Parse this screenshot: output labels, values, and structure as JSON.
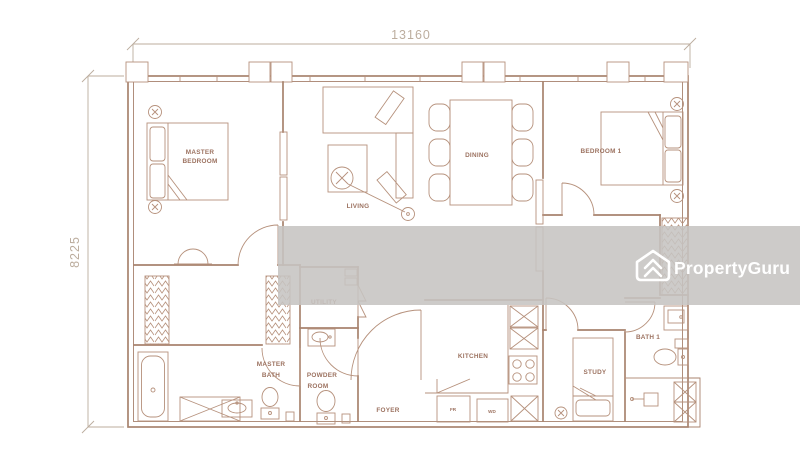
{
  "image": {
    "type": "apartment-floor-plan",
    "width_px": 800,
    "height_px": 456
  },
  "dimensions": {
    "overall_width": "13160",
    "overall_depth": "8225"
  },
  "rooms": {
    "master_bedroom": {
      "line1": "MASTER",
      "line2": "BEDROOM"
    },
    "living": {
      "label": "LIVING"
    },
    "dining": {
      "label": "DINING"
    },
    "bedroom1": {
      "label": "BEDROOM 1"
    },
    "utility": {
      "label": "UTILITY"
    },
    "master_bath": {
      "line1": "MASTER",
      "line2": "BATH"
    },
    "powder_room": {
      "line1": "POWDER",
      "line2": "ROOM"
    },
    "foyer": {
      "label": "FOYER"
    },
    "kitchen": {
      "label": "KITCHEN"
    },
    "study": {
      "label": "STUDY"
    },
    "bath1": {
      "label": "BATH 1"
    }
  },
  "appliances": {
    "fridge": "FR",
    "washer_dryer": "WD"
  },
  "watermark": {
    "brand": "PropertyGuru",
    "logo_icon": "propertyguru-chevron-house-logo"
  },
  "colors": {
    "plan_line": "#a8836e",
    "furniture_line": "#b6917c",
    "label_text": "#9c7260",
    "dimension_text": "#bcad9e",
    "watermark_band": "#c6c4c2",
    "watermark_text": "#ffffff",
    "background": "#ffffff"
  }
}
